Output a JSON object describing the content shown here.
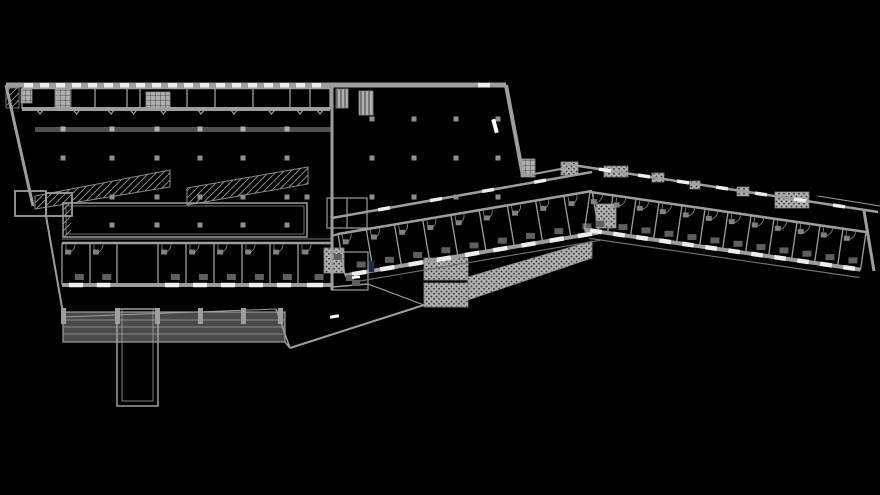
{
  "meta": {
    "width": 880,
    "height": 495,
    "background": "#000000",
    "drawing_type": "architectural-floor-plan"
  },
  "colors": {
    "background": "#000000",
    "wall": "#9e9e9e",
    "wall_bright": "#b5b5b5",
    "wall_dark": "#4f4f4f",
    "thin_line": "#8a8a8a",
    "dim_line": "#6f6f6f",
    "ramp_fill": "#4a4a4a",
    "window": "#ededed",
    "furniture_dark": "#5f5f5f",
    "furniture_light": "#7d7d7d",
    "column": "#8f8f8f",
    "column_bright": "#b0b0b0",
    "pattern_bg": "#b0b0b0",
    "pattern_ink": "#2e2e2e",
    "accent_navy": "#1c2742",
    "white_mark": "#ffffff"
  },
  "plan": {
    "walls": [
      [
        6,
        85,
        506,
        85,
        5
      ],
      [
        6,
        85,
        33,
        206,
        3
      ],
      [
        46,
        216,
        63,
        313,
        2
      ],
      [
        506,
        85,
        523,
        176,
        4
      ],
      [
        332,
        85,
        332,
        290,
        3
      ],
      [
        523,
        176,
        566,
        168,
        2
      ],
      [
        63,
        317,
        276,
        309,
        1
      ],
      [
        276,
        309,
        290,
        348,
        1.5
      ],
      [
        285,
        342,
        290,
        348,
        1.5
      ],
      [
        290,
        348,
        424,
        305,
        2
      ],
      [
        332,
        287,
        368,
        284,
        1.5
      ],
      [
        368,
        284,
        424,
        305,
        1.2
      ],
      [
        332,
        236,
        338,
        234,
        2
      ],
      [
        818,
        196,
        880,
        206,
        1
      ],
      [
        864,
        211,
        874,
        271,
        3
      ],
      [
        347,
        198,
        347,
        228,
        1.2
      ],
      [
        62,
        239,
        332,
        239,
        0.8
      ]
    ],
    "canopies": [
      {
        "from": [
          332,
          218
        ],
        "to": [
          592,
          172
        ],
        "width": 2.5,
        "gaps": 4,
        "gap_len": 12
      },
      {
        "from": [
          566,
          164
        ],
        "to": [
          878,
          212
        ],
        "width": 2.5,
        "gaps": 7,
        "gap_len": 12
      }
    ],
    "outline_rects": [
      {
        "x": 63,
        "y": 203,
        "w": 244,
        "h": 34,
        "sw": 1.5
      },
      {
        "x": 66,
        "y": 206,
        "w": 238,
        "h": 28,
        "sw": 0.7
      },
      {
        "x": 117,
        "y": 309,
        "w": 41,
        "h": 97,
        "sw": 1.5
      },
      {
        "x": 122,
        "y": 309,
        "w": 31,
        "h": 92,
        "sw": 0.8
      },
      {
        "x": 15,
        "y": 191,
        "w": 31,
        "h": 25,
        "sw": 1.8
      },
      {
        "x": 46,
        "y": 193,
        "w": 26,
        "h": 23,
        "sw": 1.8
      },
      {
        "x": 327,
        "y": 198,
        "w": 40,
        "h": 30,
        "sw": 1.2
      },
      {
        "x": 332,
        "y": 252,
        "w": 36,
        "h": 38,
        "sw": 1.2
      }
    ],
    "ramp_band": {
      "x": 63,
      "y": 312,
      "w": 222,
      "h": 30,
      "inner_lines_y": [
        320,
        327,
        334
      ],
      "posts_x": [
        63,
        117,
        157,
        200,
        243,
        280
      ]
    },
    "wedge_ramps": [
      {
        "points": [
          [
            35,
            196
          ],
          [
            170,
            170
          ],
          [
            170,
            187
          ],
          [
            35,
            209
          ]
        ]
      },
      {
        "points": [
          [
            187,
            188
          ],
          [
            308,
            167
          ],
          [
            308,
            184
          ],
          [
            187,
            205
          ]
        ]
      }
    ],
    "big_rect_hatch": {
      "x": 63,
      "y": 203,
      "w": 8,
      "h": 34
    },
    "dark_wall": {
      "x": 35,
      "y": 127,
      "w": 297,
      "h": 5
    },
    "bands": [
      {
        "name": "top-strip-rooms",
        "north": [
          22,
          88,
          330,
          88
        ],
        "depth": 21,
        "dividers": [
          22,
          58,
          95,
          127,
          140,
          187,
          215,
          253,
          290,
          310,
          330
        ],
        "windows": false,
        "furniture": false,
        "door_style": "notch",
        "balcony": 0
      },
      {
        "name": "south-row-rooms",
        "north": [
          62,
          243,
          332,
          243
        ],
        "depth": 42,
        "dividers": [
          62,
          90,
          117,
          158,
          186,
          214,
          242,
          270,
          298,
          332
        ],
        "passage_segments": [
          2
        ],
        "windows": true,
        "furniture": true,
        "door_style": "arc",
        "balcony": 0
      },
      {
        "name": "mid-wing-rooms",
        "north": [
          338,
          234,
          592,
          191
        ],
        "depth": 42,
        "rooms": 9,
        "windows": true,
        "furniture": true,
        "door_style": "arc",
        "balcony": 8
      },
      {
        "name": "right-wing-rooms",
        "north": [
          590,
          192,
          866,
          232
        ],
        "depth": 38,
        "rooms": 12,
        "windows": true,
        "furniture": true,
        "door_style": "arc",
        "balcony": 8
      }
    ],
    "top_wall_windows": {
      "x_start": 24,
      "x_end": 326,
      "pitch": 16,
      "width": 9,
      "y": 83,
      "h": 4.5,
      "extra": [
        [
          478,
          83,
          12,
          4.5
        ]
      ]
    },
    "stairs": [
      {
        "x": 6,
        "y": 88,
        "w": 13,
        "h": 20,
        "p": "diag"
      },
      {
        "x": 21,
        "y": 89,
        "w": 11,
        "h": 14,
        "p": "grid"
      },
      {
        "x": 55,
        "y": 89,
        "w": 16,
        "h": 19,
        "p": "grid"
      },
      {
        "x": 146,
        "y": 92,
        "w": 24,
        "h": 16,
        "p": "grid"
      },
      {
        "x": 336,
        "y": 89,
        "w": 12,
        "h": 19,
        "p": "vl"
      },
      {
        "x": 359,
        "y": 91,
        "w": 14,
        "h": 24,
        "p": "vl"
      },
      {
        "x": 521,
        "y": 159,
        "w": 14,
        "h": 18,
        "p": "grid"
      },
      {
        "x": 561,
        "y": 162,
        "w": 17,
        "h": 13,
        "p": "dots"
      },
      {
        "x": 596,
        "y": 204,
        "w": 20,
        "h": 24,
        "p": "dots"
      },
      {
        "x": 324,
        "y": 248,
        "w": 20,
        "h": 25,
        "p": "dots"
      },
      {
        "x": 424,
        "y": 258,
        "w": 44,
        "h": 22,
        "p": "dots"
      },
      {
        "x": 424,
        "y": 283,
        "w": 44,
        "h": 24,
        "p": "dots"
      }
    ],
    "planters": [
      {
        "x": 604,
        "y": 166,
        "w": 24,
        "h": 11
      },
      {
        "x": 652,
        "y": 173,
        "w": 12,
        "h": 9
      },
      {
        "x": 690,
        "y": 181,
        "w": 10,
        "h": 8
      },
      {
        "x": 737,
        "y": 187,
        "w": 12,
        "h": 9
      },
      {
        "x": 775,
        "y": 192,
        "w": 34,
        "h": 16
      }
    ],
    "walkway": {
      "points": [
        [
          468,
          277
        ],
        [
          592,
          241
        ],
        [
          592,
          258
        ],
        [
          468,
          300
        ]
      ]
    },
    "columns": {
      "normal": [
        [
          63,
          158
        ],
        [
          112,
          158
        ],
        [
          157,
          158
        ],
        [
          200,
          158
        ],
        [
          243,
          158
        ],
        [
          287,
          158
        ],
        [
          112,
          197
        ],
        [
          157,
          197
        ],
        [
          200,
          197
        ],
        [
          243,
          197
        ],
        [
          287,
          197
        ],
        [
          307,
          197
        ],
        [
          112,
          225
        ],
        [
          157,
          225
        ],
        [
          200,
          225
        ],
        [
          243,
          225
        ],
        [
          287,
          225
        ],
        [
          372,
          119
        ],
        [
          414,
          119
        ],
        [
          456,
          119
        ],
        [
          498,
          119
        ],
        [
          372,
          158
        ],
        [
          414,
          158
        ],
        [
          456,
          158
        ],
        [
          498,
          158
        ],
        [
          372,
          197
        ],
        [
          414,
          197
        ],
        [
          456,
          197
        ],
        [
          498,
          197
        ]
      ],
      "bright": [
        [
          63,
          129
        ],
        [
          112,
          129
        ],
        [
          157,
          129
        ],
        [
          200,
          129
        ],
        [
          243,
          129
        ],
        [
          287,
          129
        ]
      ]
    },
    "navy_unit": {
      "x": 369,
      "y": 261,
      "w": 5,
      "h": 11
    },
    "white_marks": [
      {
        "x": 493,
        "y": 119,
        "w": 4,
        "h": 14,
        "r": -15
      },
      {
        "x": 330,
        "y": 315,
        "w": 9,
        "h": 3,
        "r": -10
      },
      {
        "x": 352,
        "y": 276,
        "w": 8,
        "h": 2.5,
        "r": -5
      }
    ],
    "terrace_furniture": [
      [
        350,
        278
      ],
      [
        338,
        257
      ],
      [
        356,
        283
      ]
    ]
  }
}
